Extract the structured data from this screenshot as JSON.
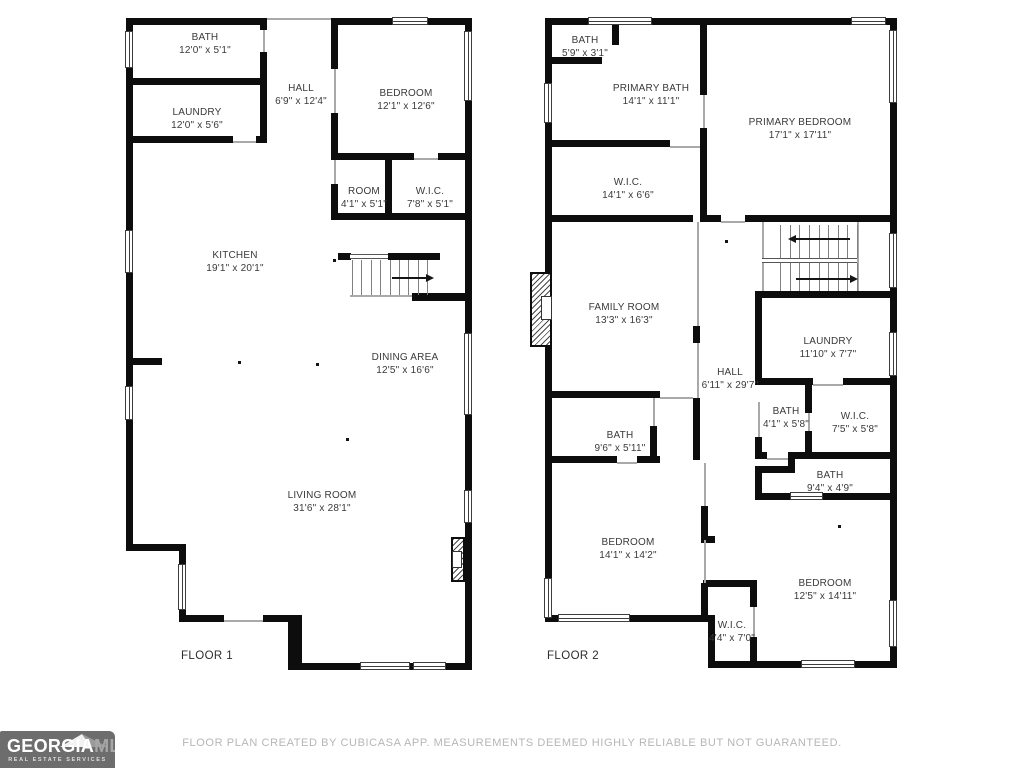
{
  "floor1": {
    "label": "FLOOR 1",
    "rooms": [
      {
        "name": "BATH",
        "dims": "12'0\" x 5'1\""
      },
      {
        "name": "LAUNDRY",
        "dims": "12'0\" x 5'6\""
      },
      {
        "name": "HALL",
        "dims": "6'9\" x 12'4\""
      },
      {
        "name": "BEDROOM",
        "dims": "12'1\" x 12'6\""
      },
      {
        "name": "ROOM",
        "dims": "4'1\" x 5'1\""
      },
      {
        "name": "W.I.C.",
        "dims": "7'8\" x 5'1\""
      },
      {
        "name": "KITCHEN",
        "dims": "19'1\" x 20'1\""
      },
      {
        "name": "DINING AREA",
        "dims": "12'5\" x 16'6\""
      },
      {
        "name": "LIVING ROOM",
        "dims": "31'6\" x 28'1\""
      }
    ]
  },
  "floor2": {
    "label": "FLOOR 2",
    "rooms": [
      {
        "name": "BATH",
        "dims": "5'9\" x 3'1\""
      },
      {
        "name": "PRIMARY BATH",
        "dims": "14'1\" x 11'1\""
      },
      {
        "name": "PRIMARY BEDROOM",
        "dims": "17'1\" x 17'11\""
      },
      {
        "name": "W.I.C.",
        "dims": "14'1\" x 6'6\""
      },
      {
        "name": "FAMILY ROOM",
        "dims": "13'3\" x 16'3\""
      },
      {
        "name": "HALL",
        "dims": "6'11\" x 29'7\""
      },
      {
        "name": "LAUNDRY",
        "dims": "11'10\" x 7'7\""
      },
      {
        "name": "BATH",
        "dims": "4'1\" x 5'8\""
      },
      {
        "name": "W.I.C.",
        "dims": "7'5\" x 5'8\""
      },
      {
        "name": "BATH",
        "dims": "9'6\" x 5'11\""
      },
      {
        "name": "BATH",
        "dims": "9'4\" x 4'9\""
      },
      {
        "name": "BEDROOM",
        "dims": "14'1\" x 14'2\""
      },
      {
        "name": "BEDROOM",
        "dims": "12'5\" x 14'11\""
      },
      {
        "name": "W.I.C.",
        "dims": "4'4\" x 7'0\""
      }
    ]
  },
  "footer": {
    "disclaimer": "FLOOR PLAN CREATED BY CUBICASA APP. MEASUREMENTS DEEMED HIGHLY RELIABLE BUT NOT GUARANTEED."
  },
  "logo": {
    "brand_primary": "GEORGIA",
    "brand_secondary": "MLS",
    "tagline": "REAL ESTATE SERVICES"
  },
  "colors": {
    "wall": "#0d0d0d",
    "label_text": "#3a3a3a",
    "disclaimer_text": "#b6b6b6",
    "logo_bg": "#6d6d6d"
  }
}
